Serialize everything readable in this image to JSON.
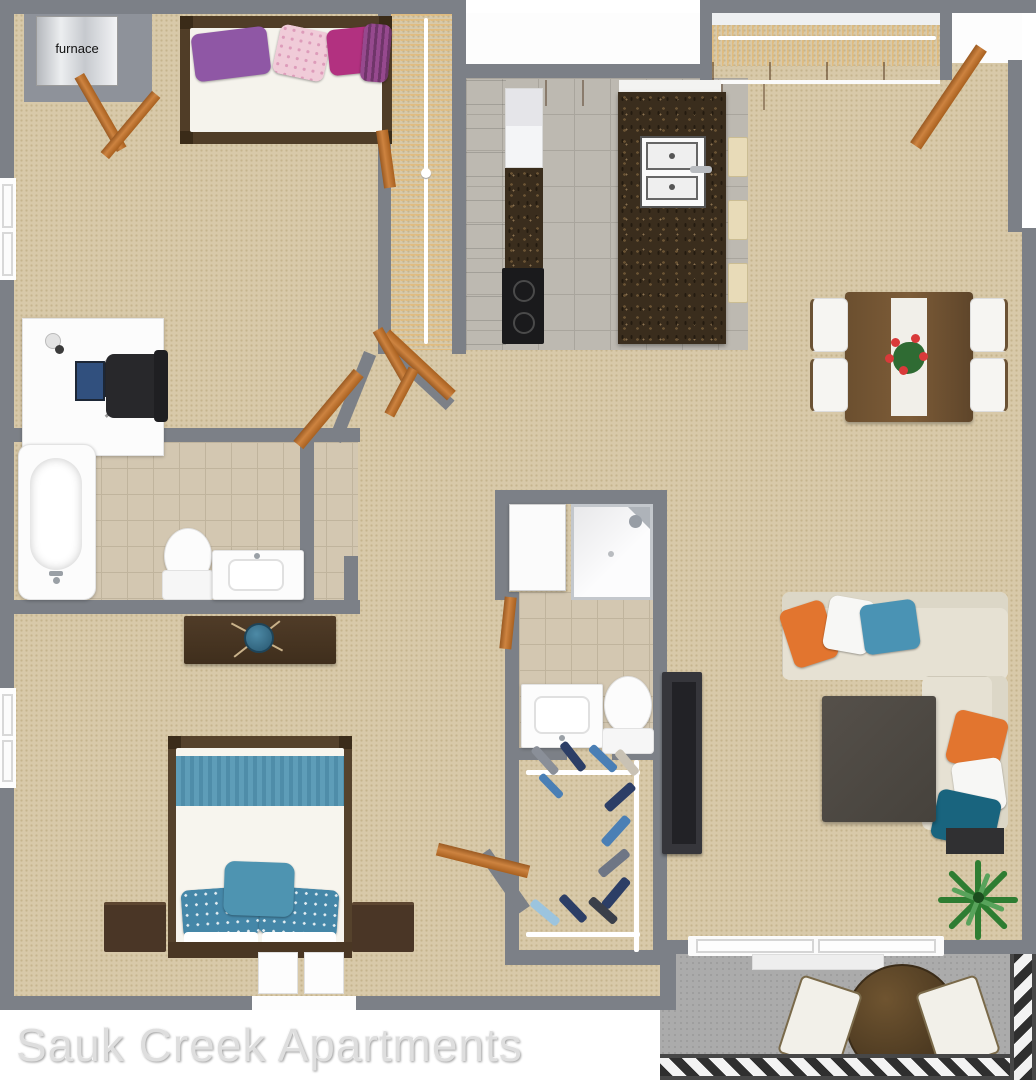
{
  "title": "Sauk Creek Apartments 3D floor plan",
  "labels": {
    "furnace": "furnace",
    "watermark": "Sauk Creek Apartments"
  },
  "palette": {
    "wall": "#7c8087",
    "carpet": "#d8c9a9",
    "carpet_dot": "#c6b48e",
    "tile_gray": "#bdb9b1",
    "tile_beige": "#d3c7b1",
    "granite_base": "#3a2d1d",
    "white_fixture": "#fcfcfc",
    "wood_light": "#cd8340",
    "wood_dark": "#9a5a22",
    "dark_wood": "#4a3724",
    "sofa": "#e6e1d3",
    "pillow_orange": "#e2752f",
    "pillow_blue": "#4a93b4",
    "pillow_teal": "#19647e",
    "pillow_purple": "#8f57a5",
    "pillow_magenta": "#b23180",
    "pillow_pink": "#f0cbd8",
    "bed_blue": "#5e9db8",
    "patio_floor": "#ababab",
    "railing_dark": "#474747",
    "plant_green": "#2e7d32",
    "black_item": "#28282b",
    "watermark_color": "#dedede"
  },
  "rooms": [
    "furnace-closet",
    "bedroom-top",
    "walk-in-closet-top",
    "kitchen",
    "coat-closet",
    "entry",
    "dining-area",
    "living-room",
    "bathroom-main",
    "hallway",
    "linen-closet",
    "shower-room",
    "bathroom-second",
    "walk-in-closet-bottom",
    "master-bedroom",
    "patio"
  ]
}
